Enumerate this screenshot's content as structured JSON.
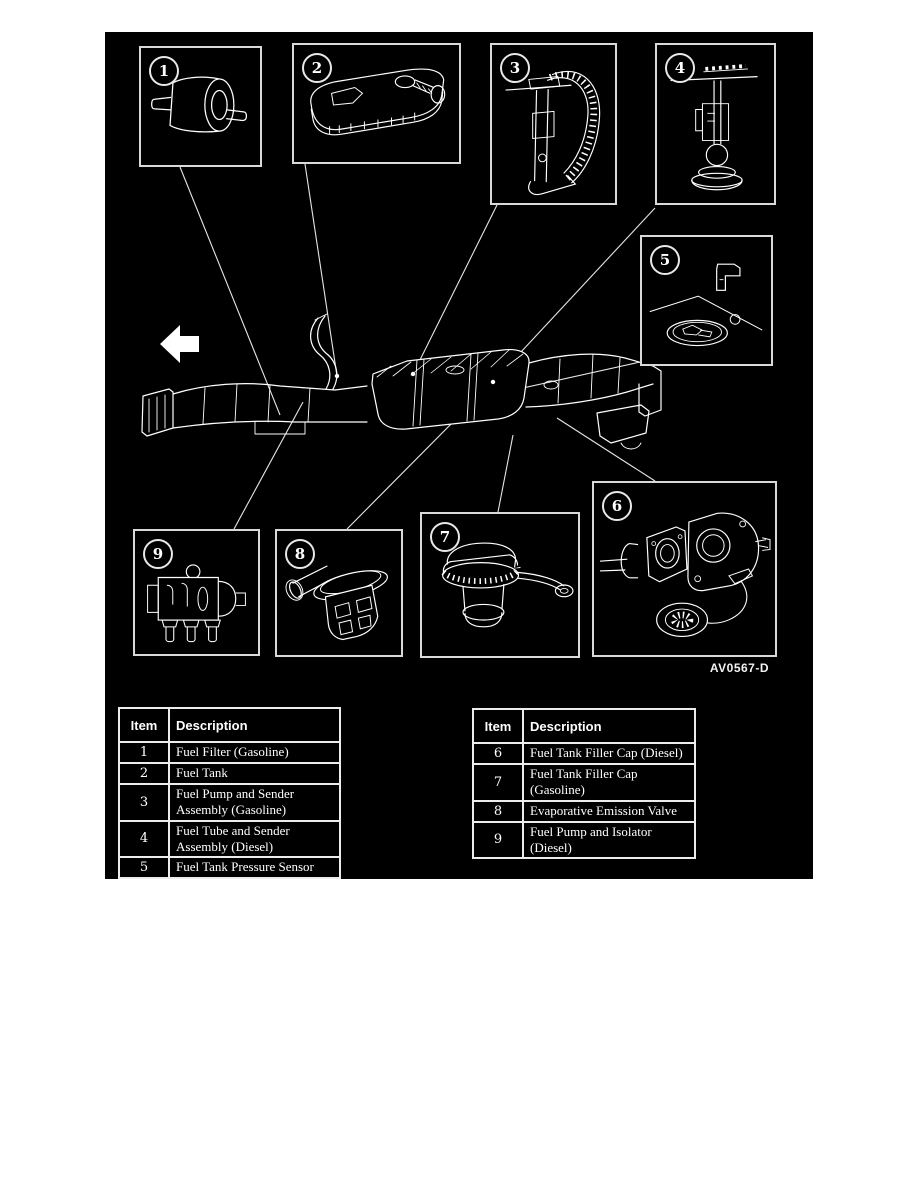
{
  "page": {
    "background": "#ffffff",
    "canvas_bg": "#000000",
    "line_color": "#ffffff"
  },
  "figure": {
    "code": "AV0567-D",
    "callouts": [
      "1",
      "2",
      "3",
      "4",
      "5",
      "6",
      "7",
      "8",
      "9"
    ],
    "arrow_direction": "left"
  },
  "tables": {
    "left": {
      "header": {
        "item": "Item",
        "description": "Description"
      },
      "rows": [
        {
          "item": "1",
          "description": "Fuel Filter (Gasoline)"
        },
        {
          "item": "2",
          "description": "Fuel Tank"
        },
        {
          "item": "3",
          "description": "Fuel Pump and Sender\nAssembly (Gasoline)"
        },
        {
          "item": "4",
          "description": "Fuel Tube and Sender\nAssembly (Diesel)"
        },
        {
          "item": "5",
          "description": "Fuel Tank Pressure Sensor"
        }
      ]
    },
    "right": {
      "header": {
        "item": "Item",
        "description": "Description"
      },
      "rows": [
        {
          "item": "6",
          "description": "Fuel Tank Filler Cap (Diesel)"
        },
        {
          "item": "7",
          "description": "Fuel Tank Filler Cap\n(Gasoline)"
        },
        {
          "item": "8",
          "description": "Evaporative Emission Valve"
        },
        {
          "item": "9",
          "description": "Fuel Pump and Isolator\n(Diesel)"
        }
      ]
    }
  }
}
